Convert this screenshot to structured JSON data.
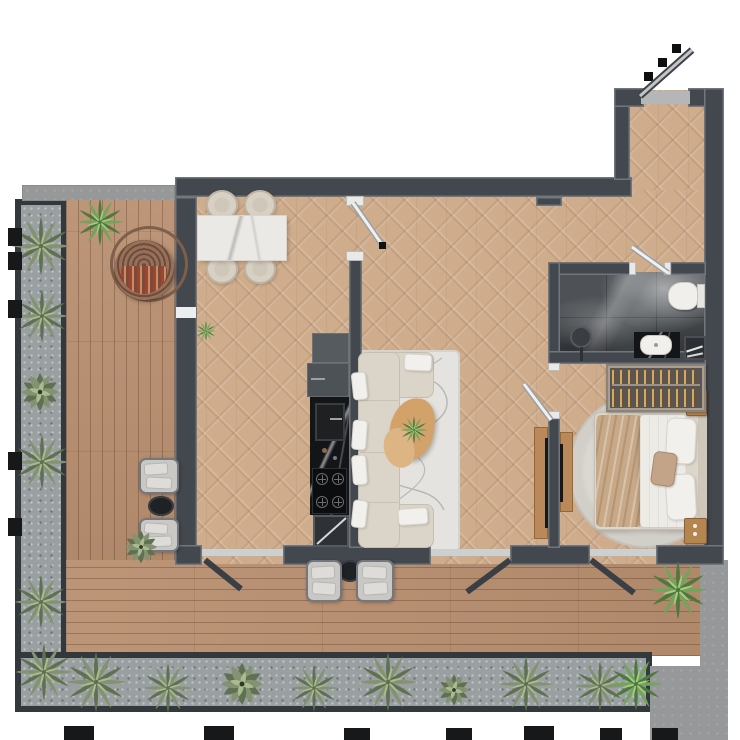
{
  "scene": {
    "title": "Apartment floor plan, top-down 3D render with wrap-around terrace",
    "rooms": [
      {
        "name": "terrace",
        "items": [
          "wood deck",
          "concrete curb",
          "hanging egg chair",
          "lounge chair",
          "lounge chair",
          "round side table",
          "lounge chair",
          "lounge chair",
          "round side table",
          "potted palm",
          "small shrub",
          "planting bed left",
          "planting bed bottom",
          "outdoor light blocks"
        ]
      },
      {
        "name": "dining-area",
        "items": [
          "marble dining table",
          "dining chair",
          "dining chair",
          "dining chair",
          "dining chair",
          "small potted plant"
        ]
      },
      {
        "name": "kitchen",
        "items": [
          "tall cabinet",
          "refrigerator",
          "black marble counter",
          "sink",
          "gas hob 4 burners",
          "open base unit"
        ]
      },
      {
        "name": "living-room",
        "items": [
          "modular sofa",
          "throw pillows",
          "area rug with line pattern",
          "organic wood coffee table",
          "table plant",
          "media wall with tv"
        ]
      },
      {
        "name": "bedroom",
        "items": [
          "double bed",
          "duvet",
          "beige blanket",
          "pillows",
          "accent pillow",
          "round rug",
          "open wardrobe with hangers",
          "nightstand",
          "nightstand",
          "tv panel"
        ]
      },
      {
        "name": "bathroom",
        "items": [
          "dark marble floor",
          "ceiling shower head",
          "wall-hung toilet",
          "vanity with basin",
          "towel box"
        ]
      },
      {
        "name": "entry-hall",
        "items": [
          "entry door open",
          "door swing marks",
          "threshold"
        ]
      }
    ],
    "doors": [
      "entry door",
      "living room door",
      "bathroom door",
      "bedroom door",
      "terrace door A",
      "terrace door B",
      "terrace door C"
    ],
    "floor_types": {
      "interior": "herringbone parquet",
      "terrace": "wood plank deck",
      "bathroom": "dark marble tile"
    }
  },
  "palette": {
    "wall": "#43484e",
    "wallEdge": "#70767d",
    "jamb": "#e9eae8",
    "parquet": "#cfad8c",
    "deck": "#b98f70",
    "curb": "#9e9f9b",
    "concrete": "#96989a",
    "gravel": "#9aa0a2",
    "bedFrame": "#33383c",
    "marbleWhite": "#ebe9e6",
    "marbleBlack": "#141518",
    "bathFloor": "#4e5256",
    "sofa": "#dbd4c8",
    "cushion": "#f2f0ec",
    "rugLiving": "#e5e3df",
    "rugBedroom": "#d2cec8",
    "woodLight": "#d3a26b",
    "woodMid": "#b5854f",
    "tvWood": "#b9895b",
    "blanket": "#c7a887",
    "duvet": "#edebe6",
    "bedBase": "#ddd6cb",
    "chairGray": "#c9c8c4",
    "chairBeige": "#d8d0c3",
    "rattan": "#8b6850",
    "rattanFrame": "#7d5f4a",
    "black": "#1f2225",
    "plantDark": "#5e7150",
    "plantMid": "#849272",
    "plantLight": "#aabb90",
    "brightDark": "#4c7a3c",
    "brightMid": "#74a45c",
    "brightLight": "#a9cc82",
    "doorWhite": "#f0f0ee",
    "doorDark": "#3a3f45",
    "steel": "#c3c5c7",
    "threshold": "#cdd0d1",
    "sill": "#b4b6b8"
  }
}
